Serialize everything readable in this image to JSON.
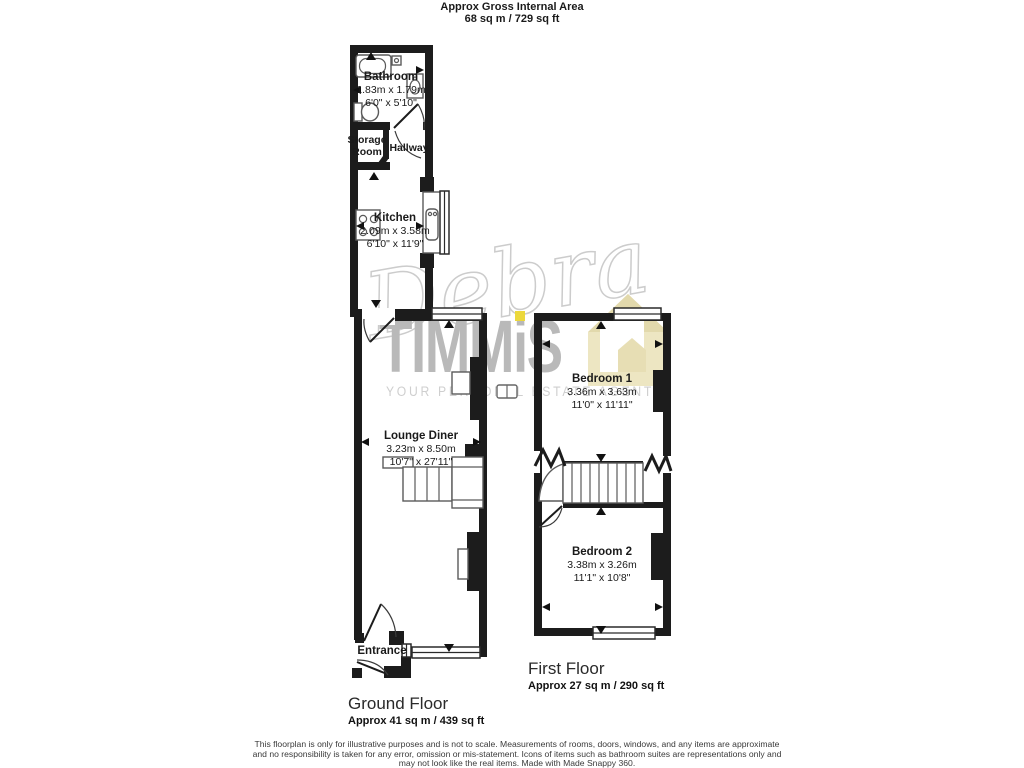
{
  "header": {
    "title": "Approx Gross Internal Area",
    "area_line": "68 sq m / 729 sq ft"
  },
  "ground_floor": {
    "label": "Ground Floor",
    "area": "Approx 41 sq m / 439 sq ft",
    "rooms": {
      "bathroom": {
        "name": "Bathroom",
        "metric": "1.83m x 1.79m",
        "imperial": "6'0\" x 5'10\""
      },
      "storage_room": {
        "name": "Storage Room"
      },
      "hallway": {
        "name": "Hallway"
      },
      "kitchen": {
        "name": "Kitchen",
        "metric": "2.09m x 3.58m",
        "imperial": "6'10\" x 11'9\""
      },
      "lounge_diner": {
        "name": "Lounge Diner",
        "metric": "3.23m x 8.50m",
        "imperial": "10'7\" x 27'11\""
      },
      "entrance": {
        "name": "Entrance"
      }
    }
  },
  "first_floor": {
    "label": "First Floor",
    "area": "Approx 27 sq m / 290 sq ft",
    "rooms": {
      "bedroom1": {
        "name": "Bedroom 1",
        "metric": "3.36m x 3.63m",
        "imperial": "11'0\" x 11'11\""
      },
      "bedroom2": {
        "name": "Bedroom 2",
        "metric": "3.38m x 3.26m",
        "imperial": "11'1\" x 10'8\""
      }
    }
  },
  "watermark": {
    "signature": "Debra",
    "brand": "TIMMiS",
    "tagline": "YOUR PERSONAL ESTATE AGENT"
  },
  "footer": {
    "disclaimer": "This floorplan is only for illustrative purposes and is not to scale. Measurements of rooms, doors, windows, and any items are approximate and no responsibility is taken for any error, omission or mis-statement. Icons of items such as bathroom suites are representations only and may not look like the real items. Made with Made Snappy 360."
  },
  "colors": {
    "wall": "#1c1c1c",
    "fixture_stroke": "#5a5a5a",
    "watermark_gray": "#c9c9c9",
    "brand_gray": "#b9b9b9",
    "accent_yellow": "#ecd83c",
    "house_cream": "#ece4bd"
  },
  "icons": {
    "bathtub-icon": "rounded-rect-tub",
    "toilet-icon": "tank-and-bowl",
    "basin-icon": "pedestal-sink",
    "hob-icon": "four-ring-hob",
    "kitchen-sink-icon": "inset-sink",
    "stairs-icon": "treads-and-landing",
    "door-arc-icon": "quarter-circle-swing",
    "window-icon": "double-line-opening",
    "measure-arrow-icon": "solid-triangle",
    "fireplace-icon": "white-inset-box",
    "radiator-icon": "bordered-box",
    "zigzag-break-icon": "triangle-wave",
    "house-logo-icon": "pentagon-house",
    "camera-360-icon": "outlined-box"
  }
}
